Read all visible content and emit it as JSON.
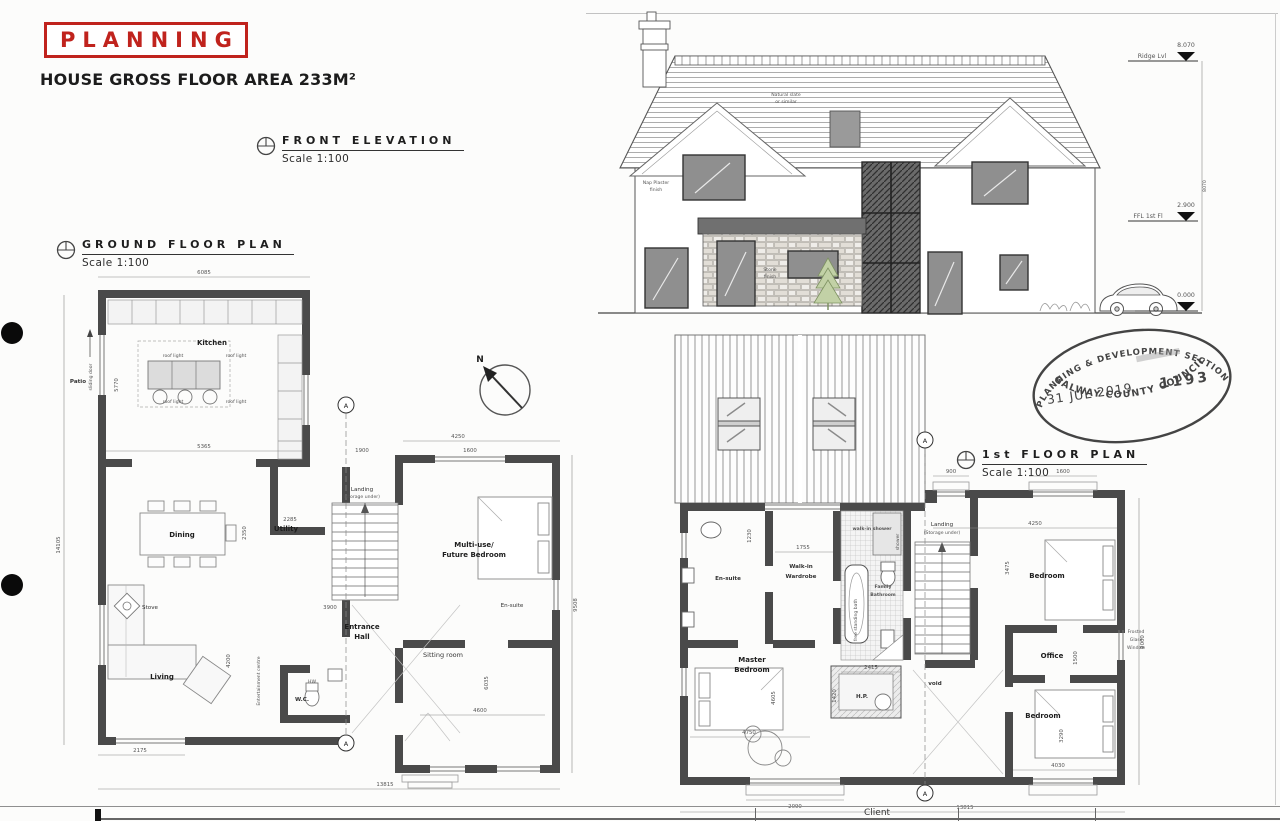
{
  "colors": {
    "wall": "#4a4a4a",
    "red": "#c0231d",
    "ink": "#2e2e2e"
  },
  "header": {
    "planning_label": "PLANNING",
    "gross_area": "HOUSE GROSS FLOOR AREA 233M²"
  },
  "sections": {
    "front_elevation": {
      "title": "FRONT ELEVATION",
      "scale": "Scale 1:100"
    },
    "ground_floor": {
      "title": "GROUND FLOOR PLAN",
      "scale": "Scale 1:100"
    },
    "first_floor": {
      "title": "1st FLOOR PLAN",
      "scale": "Scale 1:100"
    }
  },
  "stamp": {
    "arc_top": "PLANNING & DEVELOPMENT SECTION",
    "date": "31 JUL 2019",
    "number": "1193",
    "arc_bottom": "GALWAY COUNTY COUNCIL"
  },
  "elevation": {
    "roof_note_line1": "Natural slate",
    "roof_note_line2": "or similar",
    "wall_note_line1": "Nap Plaster",
    "wall_note_line2": "finish",
    "stone_note_line1": "Stone",
    "stone_note_line2": "finish",
    "ridge_value": "8.070",
    "ridge_label": "Ridge Lvl",
    "ffl_value": "2.900",
    "ffl_label": "FFL 1st Fl",
    "ground_value": "0.000",
    "overall_height": "8070"
  },
  "gf": {
    "north": "N",
    "section_marker": "A",
    "rooms": {
      "kitchen": "Kitchen",
      "dining": "Dining",
      "utility": "Utility",
      "living": "Living",
      "entrance_line1": "Entrance",
      "entrance_line2": "Hall",
      "sitting": "Sitting room",
      "multiuse_line1": "Multi-use/",
      "multiuse_line2": "Future Bedroom",
      "ensuite": "En-suite",
      "wc": "W.C.",
      "landing_line1": "Landing",
      "landing_line2": "(storage under)"
    },
    "labels": {
      "patio": "Patio",
      "sliding_door": "sliding door",
      "roof_light": "roof light",
      "stove": "Stove",
      "ent_centre": "Entertainment centre",
      "hw": "HW"
    },
    "dims": {
      "top_width": "6085",
      "left_height": "14105",
      "kitchen_width": "5365",
      "kitchen_height": "5770",
      "utility_width": "2285",
      "hall_depth": "2350",
      "living_height": "4200",
      "living_width": "2175",
      "bottom_width": "13815",
      "bedroom_width": "4250",
      "bedroom_window": "1600",
      "landing_window": "1900",
      "hall_width": "3900",
      "right_height": "9508",
      "sitting_width": "4600",
      "sitting_height": "6035"
    }
  },
  "ff": {
    "section_marker": "A",
    "rooms": {
      "ensuite": "En-suite",
      "wardrobe_line1": "Walk-in",
      "wardrobe_line2": "Wardrobe",
      "shower": "walk-in shower",
      "shower_side": "shower",
      "bathroom_line1": "Family",
      "bathroom_line2": "Bathroom",
      "bath_side": "free standing bath",
      "landing_line1": "Landing",
      "landing_line2": "(Storage under)",
      "bedroom_top": "Bedroom",
      "office": "Office",
      "bedroom_bottom": "Bedroom",
      "master_line1": "Master",
      "master_line2": "Bedroom",
      "hp": "H.P.",
      "void": "void"
    },
    "labels": {
      "frosted_line1": "Frosted",
      "frosted_line2": "Glass",
      "frosted_line3": "Window"
    },
    "dims": {
      "landing_window": "900",
      "bedroom_window": "1600",
      "bedroom_width": "4250",
      "bedroom_depth": "3475",
      "wardrobe_width": "1755",
      "ensuite_depth": "1230",
      "office_depth": "1500",
      "bedroom2_depth": "3290",
      "bedroom2_width": "4030",
      "right_height": "9000",
      "master_width": "4750",
      "master_depth": "4605",
      "master_window": "2090",
      "hp_width": "2415",
      "hp_depth": "1420",
      "bottom_width": "13815"
    }
  },
  "titleblock": {
    "client": "Client"
  }
}
